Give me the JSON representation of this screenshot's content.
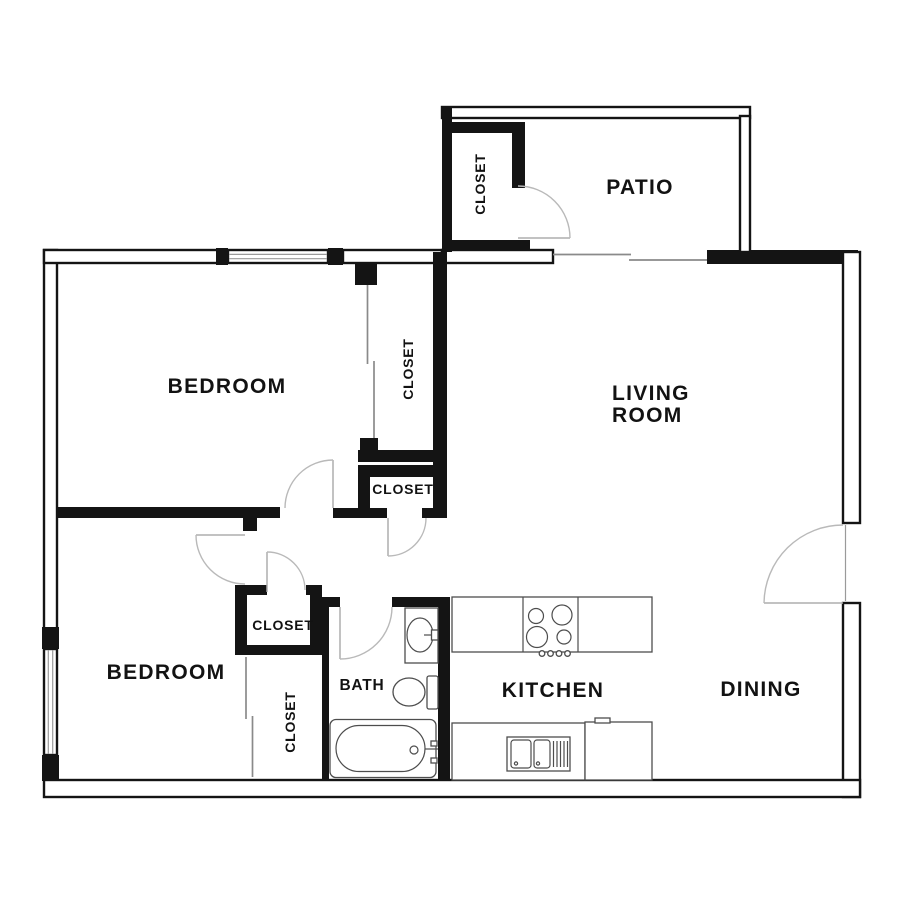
{
  "figure": {
    "type": "apartment-floor-plan"
  },
  "labels": {
    "patio": "PATIO",
    "patio_closet": "CLOSET",
    "bedroom_top": "BEDROOM",
    "bedroom_top_closet": "CLOSET",
    "living_room_line1": "LIVING",
    "living_room_line2": "ROOM",
    "hall_closet": "CLOSET",
    "bedroom_bottom": "BEDROOM",
    "lower_hall_closet": "CLOSET",
    "bedroom_bottom_closet": "CLOSET",
    "bath": "BATH",
    "kitchen": "KITCHEN",
    "dining": "DINING"
  },
  "colors": {
    "background": "#ffffff",
    "wall": "#141414",
    "door_arc": "#b9b9b9",
    "sliding_door": "#8a8a8a",
    "fixture_outline": "#4d4d4d",
    "label_text": "#121212"
  },
  "fixtures": [
    "bathtub",
    "toilet",
    "vanity-sink",
    "cooktop-burners",
    "kitchen-double-sink",
    "refrigerator",
    "window-top",
    "window-left",
    "door-swings",
    "sliding-closet-doors",
    "patio-sliding-door"
  ]
}
